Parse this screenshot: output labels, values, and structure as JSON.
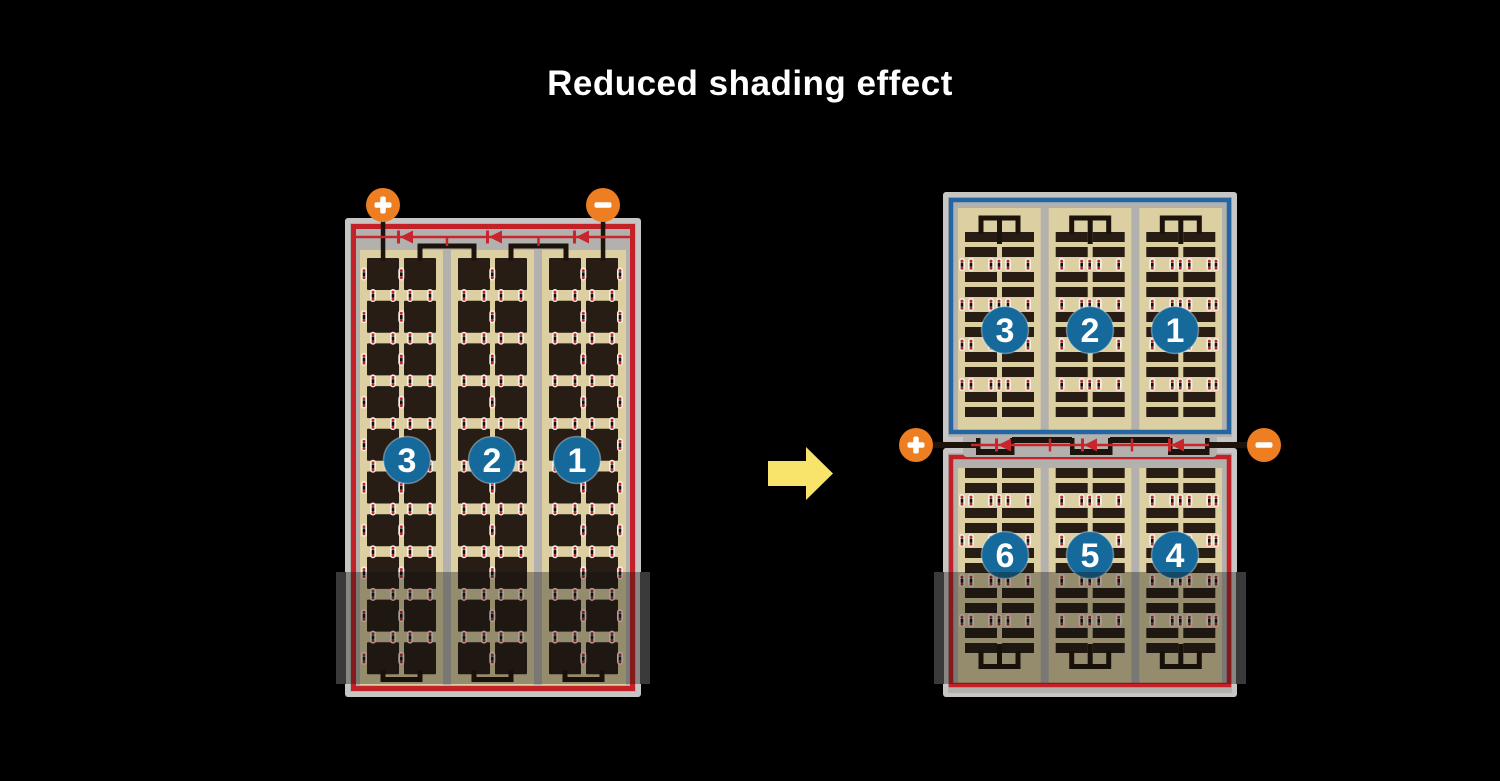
{
  "title": "Reduced shading effect",
  "colors": {
    "background": "#000000",
    "frame": "#c7c6c4",
    "inner_gray": "#b3b1ae",
    "tan": "#dccfa2",
    "cell": "#271d15",
    "red": "#c32127",
    "circuit_red": "#c8262c",
    "blue": "#2565a2",
    "circle_blue": "#156a9b",
    "terminal_orange": "#ee7e22",
    "busbar_black": "#1c130c",
    "arrow_yellow": "#f8e36b",
    "shade": "rgba(17,13,11,0.35)",
    "shade_bar": "#3a3a3a"
  },
  "left_panel": {
    "terminals": {
      "positive": "+",
      "negative": "−"
    },
    "string_labels": [
      "3",
      "2",
      "1"
    ],
    "shaded_bottom": true
  },
  "right_panel": {
    "terminals": {
      "positive": "+",
      "negative": "−"
    },
    "top_string_labels": [
      "3",
      "2",
      "1"
    ],
    "bottom_string_labels": [
      "6",
      "5",
      "4"
    ],
    "shaded_bottom": true
  },
  "arrow": {
    "direction": "right"
  }
}
